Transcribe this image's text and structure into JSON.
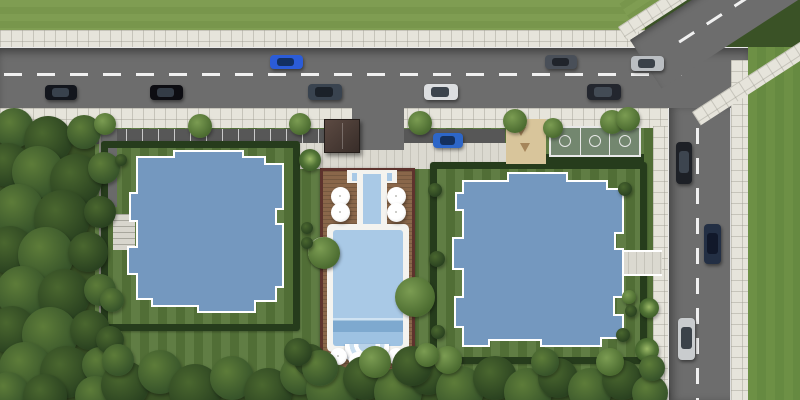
{
  "meta": {
    "type": "aerial-3d-render",
    "description": "Top-down architectural rendering of a residential complex: two blue-roofed buildings in hedged parcels, central swimming pool with wooden deck and umbrellas, basketball court and sand playground, perimeter roads with cars, dense trees left and bottom"
  },
  "palette": {
    "forest_floor": "#3a5226",
    "lawn": "#57763a",
    "grass_top": "#7f9d52",
    "grass_top2": "#78964c",
    "grass_right": "#6d9045",
    "grass_right2": "#668a41",
    "sidewalk": "#e6e4db",
    "plaza": "#dbd9d0",
    "road": "#6d6d6d",
    "road_line": "#f0f0f0",
    "parking": "#575757",
    "hedge": "#263c1c",
    "roof": "#7498bf",
    "roof_edge": "#ffffff",
    "deck": "#8a674a",
    "deck_border": "#5e332d",
    "coping": "#f4f3ef",
    "pool_water": "#a9c9e6",
    "pool_deep": "#7ea9cf",
    "sand": "#d8c59b",
    "court": "#73876f",
    "kiosk_roof": "#4a3a34"
  },
  "buildings": [
    {
      "id": "building-left-roof",
      "points": "137,157 174,157 174,151 243,151 243,157 265,157 265,164 283,164 283,209 276,209 276,224 283,224 283,287 276,287 276,301 255,301 255,312 198,312 198,306 152,306 152,299 137,299 137,274 128,274 128,247 137,247 137,221 130,221 130,193 137,193"
    },
    {
      "id": "building-right-roof",
      "points": "463,181 508,181 508,173 567,173 567,181 607,181 607,189 623,189 623,233 615,233 615,249 623,249 623,297 614,297 614,315 623,315 623,338 601,338 601,346 541,346 541,340 489,340 489,346 463,346 463,327 455,327 455,297 463,297 463,269 453,269 453,238 463,238 463,210 456,210 456,193 463,193"
    }
  ],
  "cars": [
    {
      "x": 45,
      "y": 85,
      "w": 32,
      "h": 15,
      "body": "#13161d",
      "glass": "#39424d",
      "dir": "h"
    },
    {
      "x": 150,
      "y": 85,
      "w": 33,
      "h": 15,
      "body": "#0d0d12",
      "glass": "#343c46",
      "dir": "h"
    },
    {
      "x": 270,
      "y": 55,
      "w": 33,
      "h": 14,
      "body": "#2b5cd8",
      "glass": "#123063",
      "dir": "h"
    },
    {
      "x": 308,
      "y": 84,
      "w": 34,
      "h": 16,
      "body": "#39434f",
      "glass": "#1b2129",
      "dir": "h"
    },
    {
      "x": 424,
      "y": 84,
      "w": 34,
      "h": 16,
      "body": "#dcdee0",
      "glass": "#3c444d",
      "dir": "h"
    },
    {
      "x": 545,
      "y": 55,
      "w": 32,
      "h": 14,
      "body": "#494f58",
      "glass": "#20242b",
      "dir": "h"
    },
    {
      "x": 587,
      "y": 84,
      "w": 34,
      "h": 16,
      "body": "#23262e",
      "glass": "#434b55",
      "dir": "h"
    },
    {
      "x": 631,
      "y": 56,
      "w": 33,
      "h": 15,
      "body": "#babec2",
      "glass": "#3a4149",
      "dir": "h"
    },
    {
      "x": 433,
      "y": 133,
      "w": 30,
      "h": 15,
      "body": "#2d66c8",
      "glass": "#14305e",
      "dir": "h"
    },
    {
      "x": 676,
      "y": 142,
      "w": 16,
      "h": 42,
      "body": "#1d2026",
      "glass": "#3d454f",
      "dir": "v"
    },
    {
      "x": 704,
      "y": 224,
      "w": 17,
      "h": 40,
      "body": "#232f44,",
      "glass": "#11182a",
      "dir": "v"
    },
    {
      "x": 678,
      "y": 318,
      "w": 17,
      "h": 42,
      "body": "#c9ccce",
      "glass": "#3b4249",
      "dir": "v"
    }
  ],
  "umbrellas": [
    {
      "x": 340,
      "y": 196,
      "s": 19
    },
    {
      "x": 340,
      "y": 212,
      "s": 19
    },
    {
      "x": 396,
      "y": 196,
      "s": 19
    },
    {
      "x": 396,
      "y": 212,
      "s": 19
    },
    {
      "x": 338,
      "y": 356,
      "s": 17
    },
    {
      "x": 357,
      "y": 360,
      "s": 17
    },
    {
      "x": 377,
      "y": 360,
      "s": 17
    },
    {
      "x": 396,
      "y": 356,
      "s": 17
    }
  ],
  "planters": [
    {
      "x": 308,
      "y": 237,
      "s": 31,
      "tr": 16,
      "v": "l"
    },
    {
      "x": 397,
      "y": 279,
      "s": 35,
      "tr": 20,
      "v": "l"
    }
  ],
  "trees": [
    [
      14,
      128,
      20,
      "m"
    ],
    [
      48,
      140,
      24,
      "d"
    ],
    [
      84,
      132,
      17,
      "m"
    ],
    [
      8,
      165,
      22,
      "d"
    ],
    [
      38,
      172,
      26,
      "m"
    ],
    [
      76,
      180,
      26,
      "d"
    ],
    [
      104,
      168,
      16,
      "m"
    ],
    [
      18,
      210,
      26,
      "m"
    ],
    [
      62,
      218,
      28,
      "d"
    ],
    [
      100,
      212,
      16,
      "d"
    ],
    [
      10,
      250,
      24,
      "d"
    ],
    [
      46,
      255,
      28,
      "m"
    ],
    [
      88,
      252,
      20,
      "d"
    ],
    [
      22,
      292,
      26,
      "m"
    ],
    [
      64,
      295,
      26,
      "d"
    ],
    [
      100,
      290,
      16,
      "m"
    ],
    [
      12,
      330,
      24,
      "d"
    ],
    [
      50,
      335,
      28,
      "m"
    ],
    [
      90,
      330,
      20,
      "d"
    ],
    [
      25,
      368,
      26,
      "m"
    ],
    [
      66,
      372,
      26,
      "d"
    ],
    [
      8,
      392,
      20,
      "m"
    ],
    [
      100,
      365,
      18,
      "m"
    ],
    [
      45,
      396,
      22,
      "d"
    ],
    [
      95,
      396,
      20,
      "m"
    ],
    [
      110,
      340,
      14,
      "d"
    ],
    [
      112,
      300,
      12,
      "m"
    ],
    [
      125,
      385,
      24,
      "d"
    ],
    [
      160,
      372,
      22,
      "m"
    ],
    [
      195,
      390,
      26,
      "d"
    ],
    [
      232,
      378,
      22,
      "m"
    ],
    [
      268,
      392,
      24,
      "d"
    ],
    [
      300,
      375,
      20,
      "m"
    ],
    [
      332,
      390,
      26,
      "m"
    ],
    [
      365,
      378,
      22,
      "d"
    ],
    [
      398,
      392,
      24,
      "m"
    ],
    [
      428,
      375,
      20,
      "d"
    ],
    [
      460,
      390,
      24,
      "m"
    ],
    [
      495,
      378,
      22,
      "d"
    ],
    [
      528,
      392,
      24,
      "m"
    ],
    [
      558,
      378,
      20,
      "d"
    ],
    [
      590,
      390,
      22,
      "m"
    ],
    [
      622,
      380,
      20,
      "d"
    ],
    [
      650,
      393,
      18,
      "m"
    ],
    [
      118,
      360,
      16,
      "m"
    ],
    [
      448,
      360,
      14,
      "l"
    ],
    [
      375,
      362,
      16,
      "l"
    ],
    [
      310,
      360,
      16,
      "d"
    ],
    [
      545,
      362,
      14,
      "m"
    ],
    [
      610,
      362,
      14,
      "l"
    ],
    [
      320,
      368,
      18,
      "m"
    ],
    [
      412,
      366,
      20,
      "d"
    ],
    [
      427,
      355,
      12,
      "l"
    ],
    [
      310,
      160,
      11,
      "p"
    ],
    [
      298,
      352,
      14,
      "d"
    ],
    [
      105,
      124,
      11,
      "l"
    ],
    [
      200,
      126,
      12,
      "l"
    ],
    [
      300,
      124,
      11,
      "l"
    ],
    [
      420,
      123,
      12,
      "l"
    ],
    [
      515,
      121,
      12,
      "l"
    ],
    [
      612,
      122,
      12,
      "l"
    ],
    [
      553,
      128,
      10,
      "l"
    ],
    [
      628,
      119,
      12,
      "l"
    ],
    [
      649,
      308,
      10,
      "p"
    ],
    [
      647,
      350,
      12,
      "p"
    ],
    [
      652,
      368,
      13,
      "m"
    ],
    [
      307,
      228,
      6,
      "d"
    ],
    [
      307,
      243,
      6,
      "d"
    ],
    [
      435,
      190,
      7,
      "d"
    ],
    [
      437,
      259,
      8,
      "d"
    ],
    [
      438,
      332,
      7,
      "d"
    ],
    [
      625,
      189,
      7,
      "d"
    ],
    [
      623,
      335,
      7,
      "d"
    ],
    [
      629,
      297,
      7,
      "l"
    ],
    [
      631,
      311,
      6,
      "d"
    ],
    [
      121,
      160,
      6,
      "d"
    ]
  ]
}
